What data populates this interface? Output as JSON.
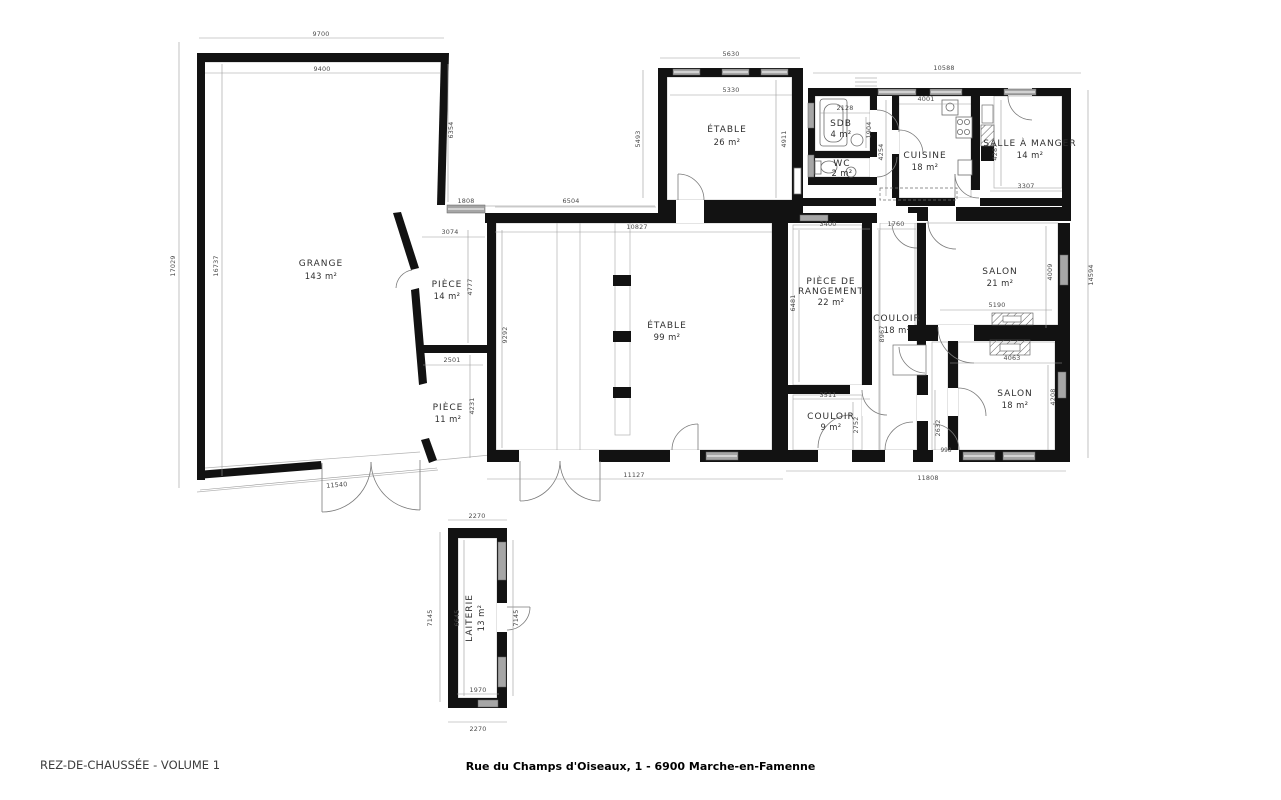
{
  "footer": {
    "plan_label": "REZ-DE-CHAUSSÉE - VOLUME 1",
    "address": "Rue du Champs d'Oiseaux, 1 - 6900 Marche-en-Famenne"
  },
  "rooms": [
    {
      "name": "GRANGE",
      "area": "143 m²"
    },
    {
      "name": "ÉTABLE",
      "area": "26 m²"
    },
    {
      "name": "SDB",
      "area": "4 m²"
    },
    {
      "name": "WC",
      "area": "2 m²"
    },
    {
      "name": "CUISINE",
      "area": "18 m²"
    },
    {
      "name": "SALLE À MANGER",
      "area": "14 m²"
    },
    {
      "name": "PIÈCE",
      "area": "14 m²"
    },
    {
      "name": "PIÈCE",
      "area": "11 m²"
    },
    {
      "name": "ÉTABLE",
      "area": "99 m²"
    },
    {
      "name": "PIÈCE DE",
      "name2": "RANGEMENT",
      "area": "22 m²"
    },
    {
      "name": "COULOIR",
      "area": "18 m²"
    },
    {
      "name": "SALON",
      "area": "21 m²"
    },
    {
      "name": "SALON",
      "area": "18 m²"
    },
    {
      "name": "COULOIR",
      "area": "9 m²"
    },
    {
      "name": "LAITERIE",
      "area": "13 m²"
    }
  ],
  "dims": {
    "g_top_outer": "9700",
    "g_top_inner": "9400",
    "g_left_outer": "17029",
    "g_left_inner": "16737",
    "g_right": "6354",
    "corridor_opening": "1808",
    "p14_top": "3074",
    "p14_right": "4777",
    "p11_top": "2501",
    "p11_right": "4231",
    "g_front": "11540",
    "e26_top_outer": "5630",
    "e26_top_inner": "5330",
    "e26_left": "5493",
    "e26_right": "4911",
    "corr_top": "6504",
    "e99_top": "10827",
    "e99_left": "9292",
    "sdb_top": "2128",
    "sdb_right": "1904",
    "house_top": "10588",
    "cuisine_top": "4001",
    "cuisine_left": "4254",
    "sam_left": "4287",
    "sam_bottom": "3307",
    "pdr_top": "3400",
    "c18_top": "1760",
    "pdr_left": "6481",
    "c18_left": "8967",
    "s21_right": "4009",
    "house_right": "14594",
    "s21_bottom": "5190",
    "s18_top": "4063",
    "s18_right": "4208",
    "pdr_bottom": "3511",
    "c9_right": "2752",
    "vest_left": "2632",
    "vest_door": "998",
    "e99_bottom": "11127",
    "house_bottom": "11808",
    "lait_top": "2270",
    "lait_left_outer": "7145",
    "lait_left_inner": "6645",
    "lait_right": "7145",
    "lait_bottom_inner": "1970",
    "lait_bottom_outer": "2270"
  },
  "colors": {
    "wall": "#121212",
    "window": "#a6a6a6",
    "text": "#3a3a3a"
  }
}
